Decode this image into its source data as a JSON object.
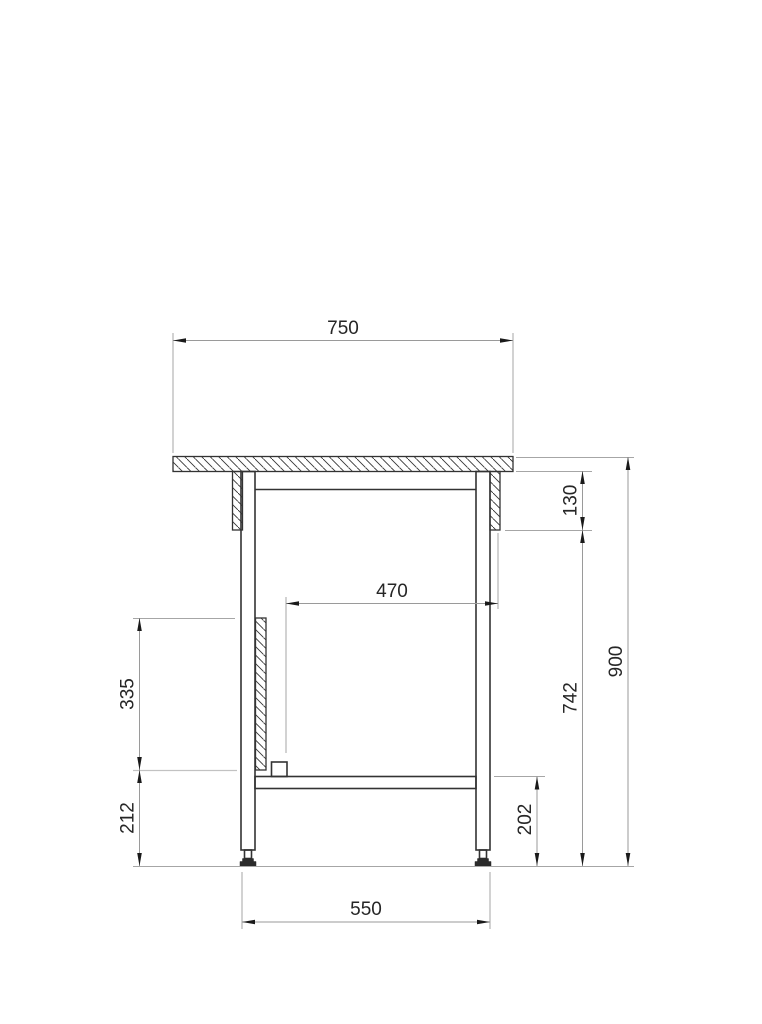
{
  "drawing": {
    "kind": "technical-drawing",
    "view": "table-side-elevation-section",
    "background_color": "#ffffff",
    "outline_color": "#333333",
    "dimension_line_color": "#9a9a9a",
    "text_color": "#262626",
    "dimensions_mm": {
      "tabletop_width": "750",
      "inner_clear_width": "470",
      "apron_height": "130",
      "bracket_height": "335",
      "lower_leg_height": "212",
      "under_top_height": "742",
      "overall_height": "900",
      "shelf_to_floor": "202",
      "leg_span": "550"
    }
  }
}
